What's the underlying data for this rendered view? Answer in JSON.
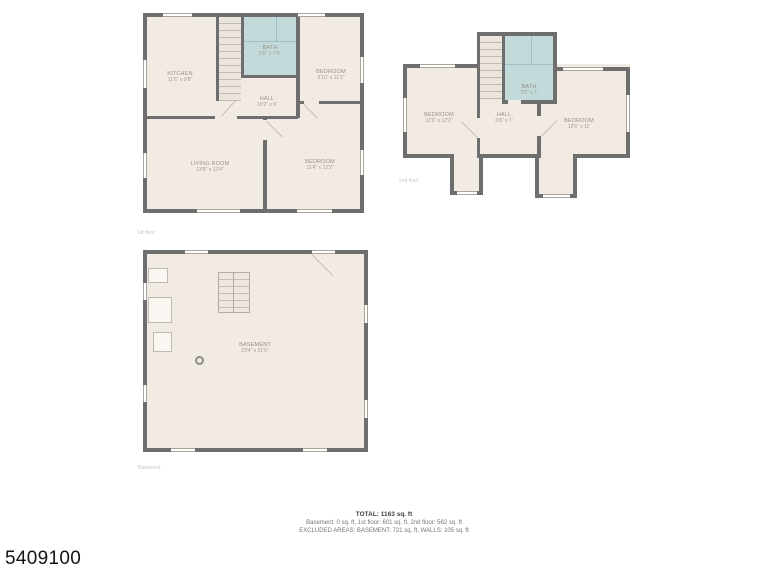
{
  "listing_id": "5409100",
  "colors": {
    "wall": "#6e6e6e",
    "room_fill": "#f2ebe4",
    "bath_fill": "#c2dbda",
    "label_text": "#96908a"
  },
  "floors": {
    "first": {
      "caption": "1st floor",
      "rooms": {
        "kitchen": {
          "name": "KITCHEN",
          "dims": "11'6\" x 9'8\""
        },
        "bath": {
          "name": "BATH",
          "dims": "5'6\" x 7'4\""
        },
        "bedroom_top": {
          "name": "BEDROOM",
          "dims": "9'10\" x 11'2\""
        },
        "hall": {
          "name": "HALL",
          "dims": "10'2\" x 6'"
        },
        "living": {
          "name": "LIVING ROOM",
          "dims": "13'8\" x 12'4\""
        },
        "bedroom_bottom": {
          "name": "BEDROOM",
          "dims": "11'4\" x 12'2\""
        }
      }
    },
    "second": {
      "caption": "2nd floor",
      "rooms": {
        "bedroom_left": {
          "name": "BEDROOM",
          "dims": "11'6\" x 12'2\""
        },
        "bath": {
          "name": "BATH",
          "dims": "7'6\" x 7'"
        },
        "hall": {
          "name": "HALL",
          "dims": "6'8\" x 7'"
        },
        "bedroom_right": {
          "name": "BEDROOM",
          "dims": "12'6\" x 11'"
        }
      }
    },
    "basement": {
      "caption": "Basement",
      "rooms": {
        "basement": {
          "name": "BASEMENT",
          "dims": "23'4\" x 21'6\""
        }
      }
    }
  },
  "summary": {
    "total": "TOTAL: 1163 sq. ft",
    "breakdown": "Basement: 0 sq. ft, 1st floor: 601 sq. ft, 2nd floor: 562 sq. ft",
    "excluded": "EXCLUDED AREAS: BASEMENT: 721 sq. ft, WALLS: 105 sq. ft"
  }
}
